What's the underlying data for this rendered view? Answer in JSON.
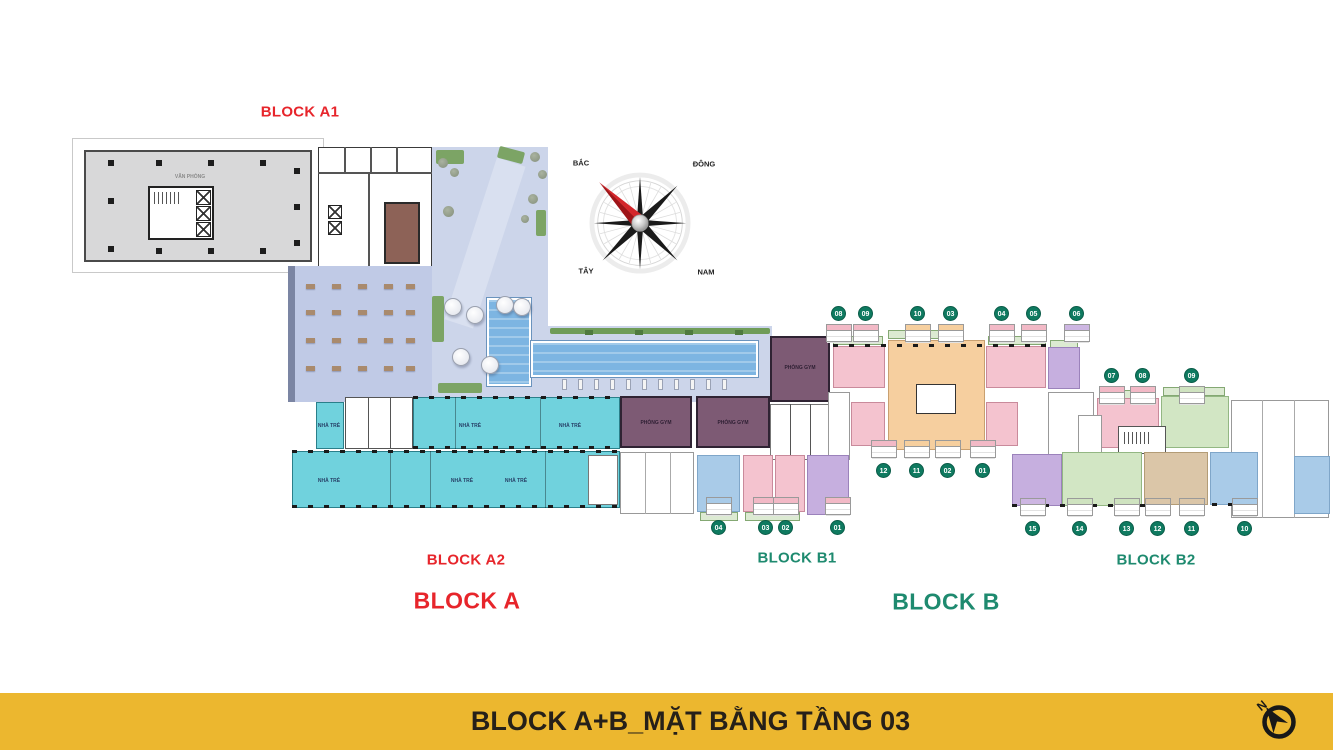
{
  "title_bar": {
    "label": "BLOCK A+B_MẶT BẰNG TẦNG 03",
    "bg_color": "#ECB72F",
    "text_color": "#262019",
    "icon": "north-arrow-icon"
  },
  "block_labels": {
    "a1": {
      "text": "BLOCK A1",
      "color": "#E7252B"
    },
    "a2": {
      "text": "BLOCK A2",
      "color": "#E7252B"
    },
    "a": {
      "text": "BLOCK A",
      "color": "#E7252B"
    },
    "b1": {
      "text": "BLOCK B1",
      "color": "#1E8A6F"
    },
    "b2": {
      "text": "BLOCK B2",
      "color": "#1E8A6F"
    },
    "b": {
      "text": "BLOCK B",
      "color": "#1E8A6F"
    }
  },
  "compass": {
    "north": "BẮC",
    "east": "ĐÔNG",
    "west": "TÂY",
    "south": "NAM",
    "needle_color": "#D4262B"
  },
  "room_labels": [
    {
      "text": "VĂN PHÒNG",
      "x": 190,
      "y": 177,
      "color": "#8a8a8a",
      "size": 5
    },
    {
      "text": "NHÀ TRẺ",
      "x": 329,
      "y": 426,
      "color": "#274067",
      "size": 5
    },
    {
      "text": "NHÀ TRẺ",
      "x": 470,
      "y": 426,
      "color": "#274067",
      "size": 5
    },
    {
      "text": "NHÀ TRẺ",
      "x": 570,
      "y": 426,
      "color": "#274067",
      "size": 5
    },
    {
      "text": "NHÀ TRẺ",
      "x": 329,
      "y": 481,
      "color": "#274067",
      "size": 5
    },
    {
      "text": "NHÀ TRẺ",
      "x": 462,
      "y": 481,
      "color": "#274067",
      "size": 5
    },
    {
      "text": "NHÀ TRẺ",
      "x": 516,
      "y": 481,
      "color": "#274067",
      "size": 5
    },
    {
      "text": "PHÒNG GYM",
      "x": 656,
      "y": 423,
      "color": "#2e1f33",
      "size": 5
    },
    {
      "text": "PHÒNG GYM",
      "x": 733,
      "y": 423,
      "color": "#2e1f33",
      "size": 5
    },
    {
      "text": "PHÒNG GYM",
      "x": 800,
      "y": 368,
      "color": "#2e1f33",
      "size": 5
    }
  ],
  "units": {
    "circle_color": "#0F7A60",
    "groups": [
      {
        "name": "b1-top",
        "y": 314,
        "table": "below",
        "items": [
          {
            "num": "08",
            "x": 839,
            "header": "#f2b9c6"
          },
          {
            "num": "09",
            "x": 866,
            "header": "#f2b9c6"
          },
          {
            "num": "10",
            "x": 918,
            "header": "#f6cf9e"
          },
          {
            "num": "03",
            "x": 951,
            "header": "#f6cf9e"
          },
          {
            "num": "04",
            "x": 1002,
            "header": "#f2b9c6"
          },
          {
            "num": "05",
            "x": 1034,
            "header": "#f2b9c6"
          },
          {
            "num": "06",
            "x": 1077,
            "header": "#cdb6e2"
          }
        ]
      },
      {
        "name": "b1-mid",
        "y": 471,
        "table": "above",
        "items": [
          {
            "num": "12",
            "x": 884,
            "header": "#f2b9c6"
          },
          {
            "num": "11",
            "x": 917,
            "header": "#f6cf9e"
          },
          {
            "num": "02",
            "x": 948,
            "header": "#f6cf9e"
          },
          {
            "num": "01",
            "x": 983,
            "header": "#f2b9c6"
          }
        ]
      },
      {
        "name": "b1-bottom",
        "y": 528,
        "table": "above",
        "items": [
          {
            "num": "04",
            "x": 719,
            "header": "#a9cbe8"
          },
          {
            "num": "03",
            "x": 766,
            "header": "#f2b9c6"
          },
          {
            "num": "02",
            "x": 786,
            "header": "#f2b9c6"
          },
          {
            "num": "01",
            "x": 838,
            "header": "#f2b9c6"
          }
        ]
      },
      {
        "name": "b2-top",
        "y": 376,
        "table": "below",
        "items": [
          {
            "num": "07",
            "x": 1112,
            "header": "#f2b9c6"
          },
          {
            "num": "08",
            "x": 1143,
            "header": "#f2b9c6"
          },
          {
            "num": "09",
            "x": 1192,
            "header": "#cfe3c0"
          }
        ]
      },
      {
        "name": "b2-bottom",
        "y": 529,
        "table": "above",
        "items": [
          {
            "num": "15",
            "x": 1033,
            "header": "#cdb6e2"
          },
          {
            "num": "14",
            "x": 1080,
            "header": "#cfe3c0"
          },
          {
            "num": "13",
            "x": 1127,
            "header": "#cfe3c0"
          },
          {
            "num": "12",
            "x": 1158,
            "header": "#dbc6a8"
          },
          {
            "num": "11",
            "x": 1192,
            "header": "#dbc6a8"
          },
          {
            "num": "10",
            "x": 1245,
            "header": "#a9cbe8"
          }
        ]
      }
    ]
  }
}
